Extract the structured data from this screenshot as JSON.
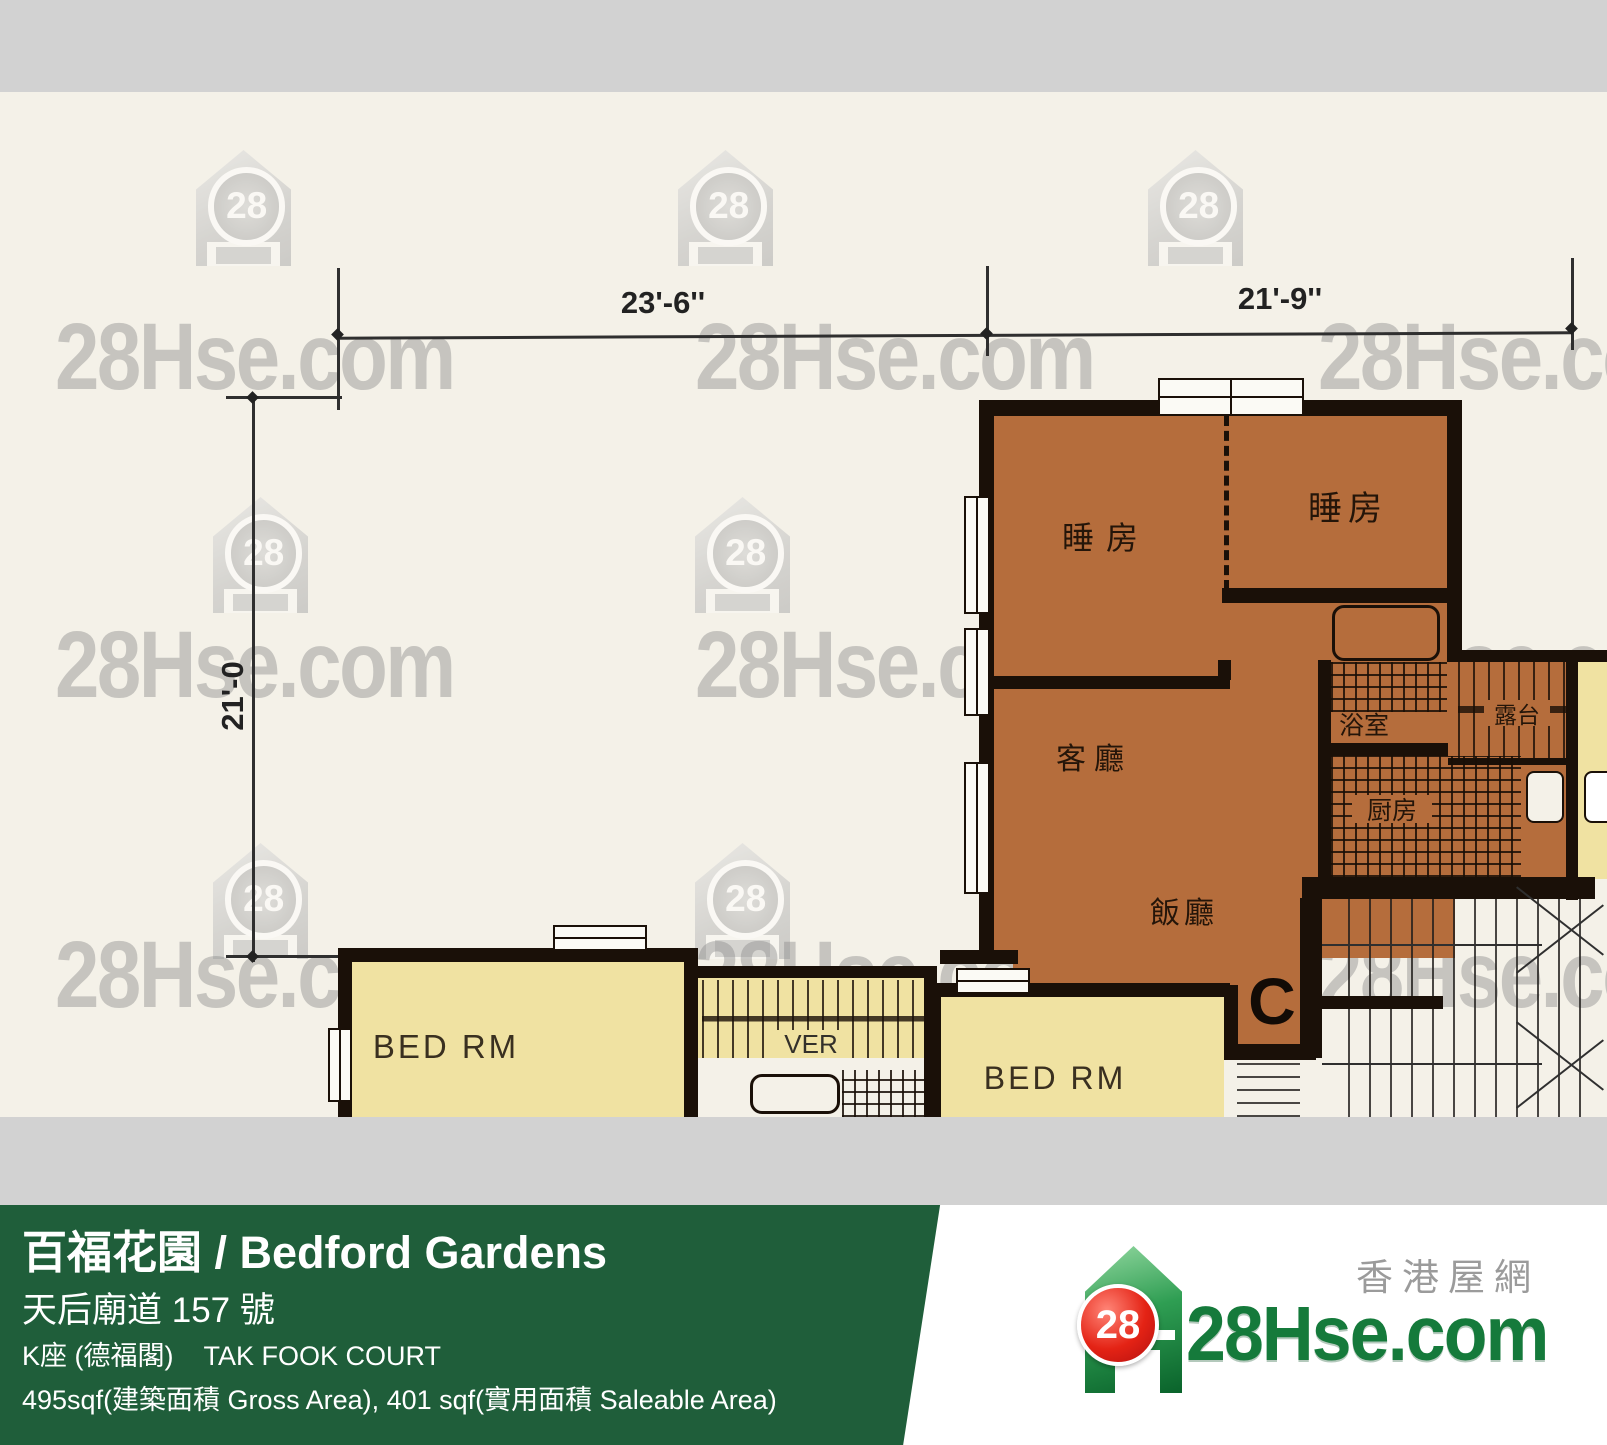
{
  "watermark": {
    "brand": "28Hse.com",
    "number": "28"
  },
  "dimensions": {
    "top_left": "23'-6''",
    "top_right": "21'-9''",
    "left_side": "21'-0"
  },
  "unit": {
    "label": "C",
    "rooms": {
      "bedroom_left": "睡房",
      "bedroom_right": "睡房",
      "living_room": "客廳",
      "dining_room": "飯廳",
      "bathroom": "浴室",
      "kitchen": "厨房",
      "balcony": "露台"
    }
  },
  "neighbors": {
    "bed_rm_left": "BED RM",
    "bed_rm_right": "BED RM",
    "verandah": "VER"
  },
  "footer": {
    "title": "百福花園 / Bedford Gardens",
    "address": "天后廟道 157 號",
    "block": "K座 (德福閣)",
    "block_en": "TAK FOOK COURT",
    "area_info": "495sqf(建築面積 Gross Area), 401 sqf(實用面積 Saleable Area)"
  },
  "logo": {
    "brand": "28Hse.com",
    "tagline": "香港屋網",
    "number": "28"
  },
  "colors": {
    "banner_green": "#1f5e3a",
    "unit_orange": "#b56d3c",
    "unit_yellow": "#f0e2a2",
    "wall": "#1a1008",
    "strip_gray": "#d2d2d2",
    "logo_green": "#157a3b",
    "logo_red": "#dd2018"
  }
}
